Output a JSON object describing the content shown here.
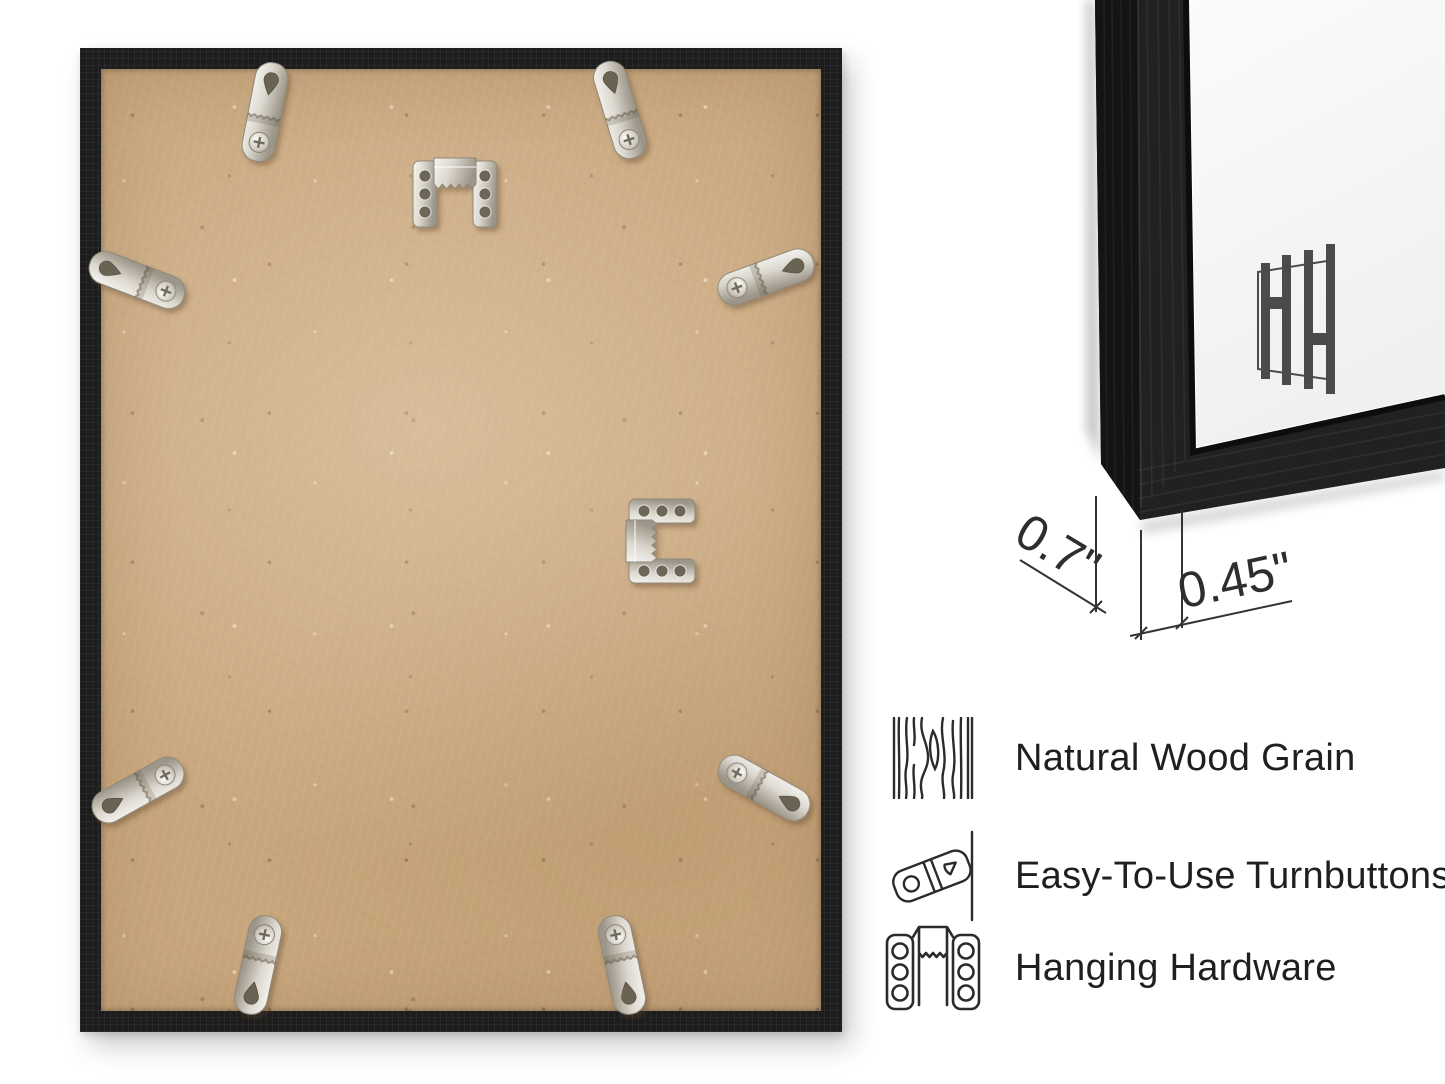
{
  "page": {
    "background": "#ffffff"
  },
  "back_view": {
    "frame_color": "#1d1d1d",
    "board_color": "#c8a67d",
    "hardware": {
      "turnbuttons_count": 8,
      "sawtooth_hangers_count": 2,
      "metal_color": "#d8d4cb"
    }
  },
  "corner_view": {
    "frame_color": "#1f1f1f",
    "mat_color": "#f6f6f4",
    "logo_letters": "HH",
    "logo_color": "#4b4b4b"
  },
  "dimensions": {
    "depth": {
      "label": "0.7\""
    },
    "face_width": {
      "label": "0.45\""
    }
  },
  "features": [
    {
      "icon": "wood-grain-icon",
      "label": "Natural Wood Grain"
    },
    {
      "icon": "turnbutton-icon",
      "label": "Easy-To-Use Turnbuttons"
    },
    {
      "icon": "hanging-hardware-icon",
      "label": "Hanging Hardware"
    }
  ],
  "text_color": "#1f1f1f",
  "line_color": "#2b2b2b"
}
